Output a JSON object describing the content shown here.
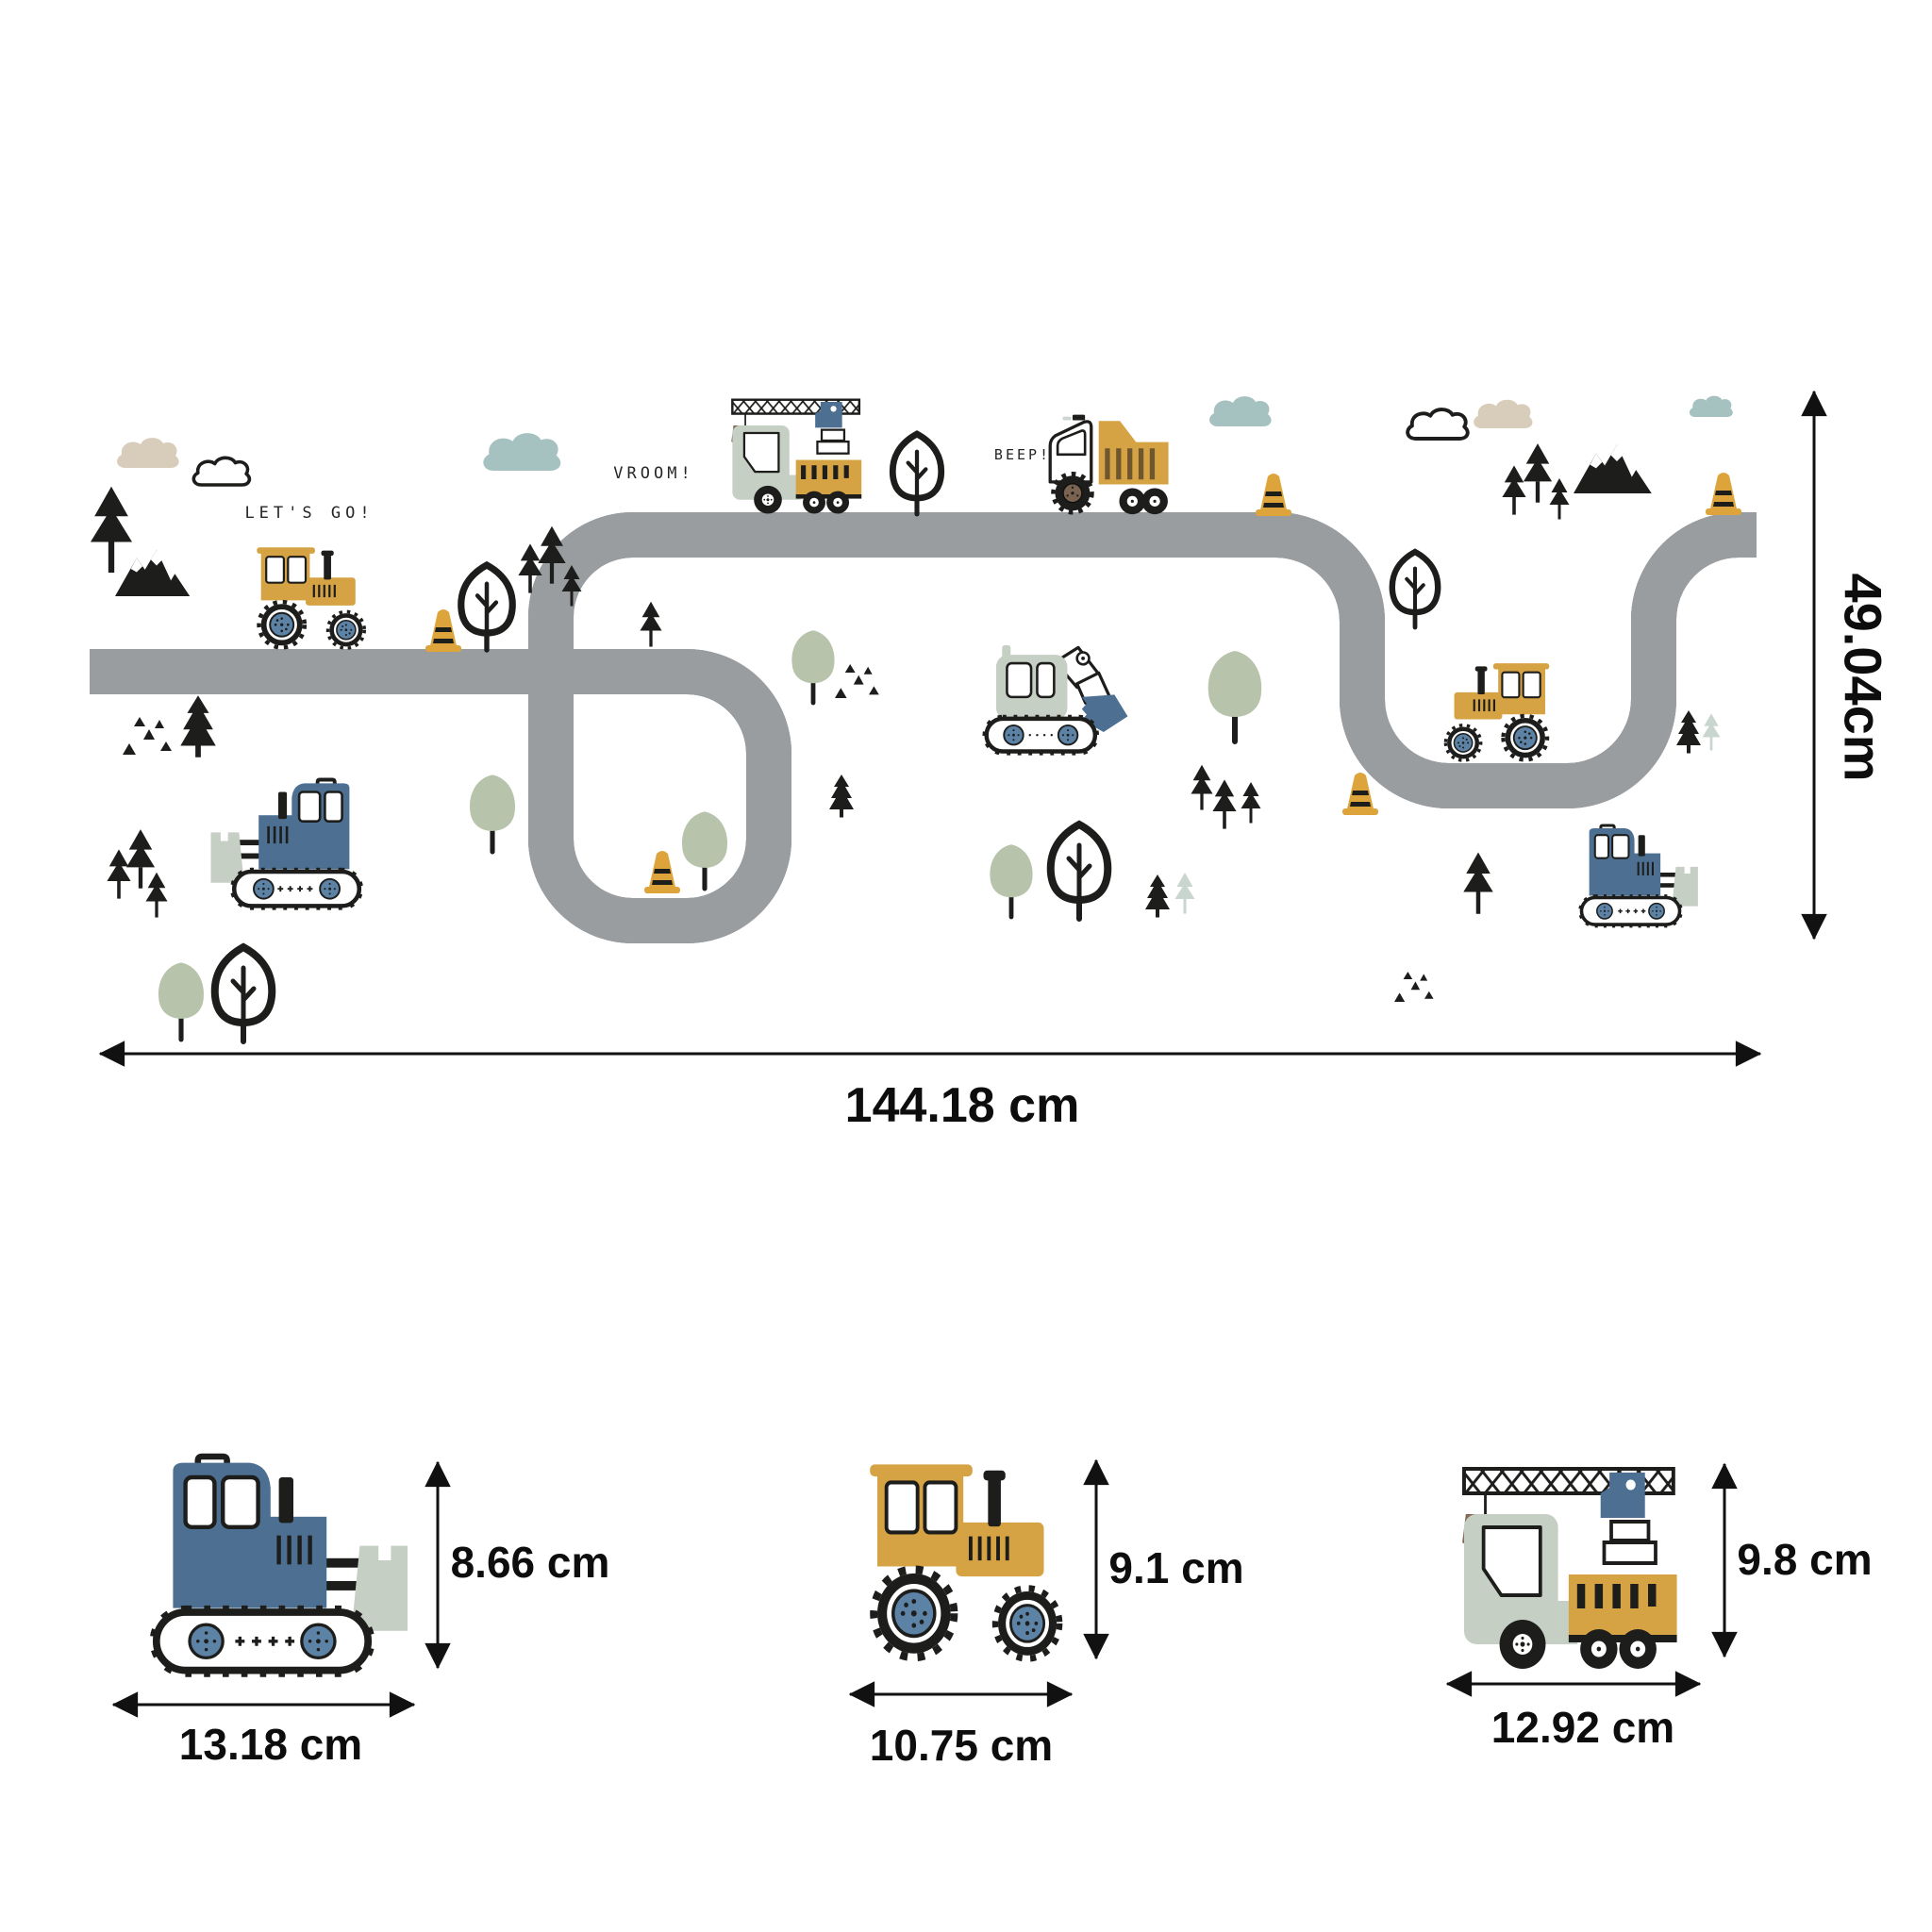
{
  "page": {
    "type": "product-dimensions-diagram",
    "subject": "kids construction vehicles road wall decal"
  },
  "scene": {
    "speech": {
      "lets_go": "LET'S GO!",
      "vroom": "VROOM!",
      "beep": "BEEP!"
    },
    "dimensions": {
      "width": "144.18 cm",
      "height": "49.04cm"
    }
  },
  "items": [
    {
      "name": "bulldozer",
      "height": "8.66 cm",
      "width": "13.18 cm"
    },
    {
      "name": "tractor",
      "height": "9.1 cm",
      "width": "10.75 cm"
    },
    {
      "name": "crane-truck",
      "height": "9.8 cm",
      "width": "12.92 cm"
    }
  ],
  "icons": {
    "vehicles": [
      "tractor",
      "dump-truck",
      "crane-truck",
      "excavator",
      "bulldozer"
    ],
    "decor": [
      "cloud",
      "pine-tree",
      "round-tree",
      "outline-tree",
      "mountains",
      "traffic-cone",
      "triangle-rocks"
    ],
    "dimension_marker": "double-headed-arrow"
  },
  "colors": {
    "road": "#9a9da0",
    "road_line": "#ffffff",
    "mustard": "#d5a344",
    "cone_yellow": "#dca43a",
    "steel_blue": "#4d7092",
    "wheel_hub_blue": "#5c82a6",
    "sage": "#c5cfc3",
    "sage_tree": "#b7c4ab",
    "pale_pine": "#c9d6d0",
    "teal_cloud": "#a6c2c0",
    "beige_cloud": "#d8cdba",
    "brown": "#846853",
    "stripe_brown": "#6e572e",
    "ink": "#1d1d1b",
    "arrow": "#111111"
  }
}
